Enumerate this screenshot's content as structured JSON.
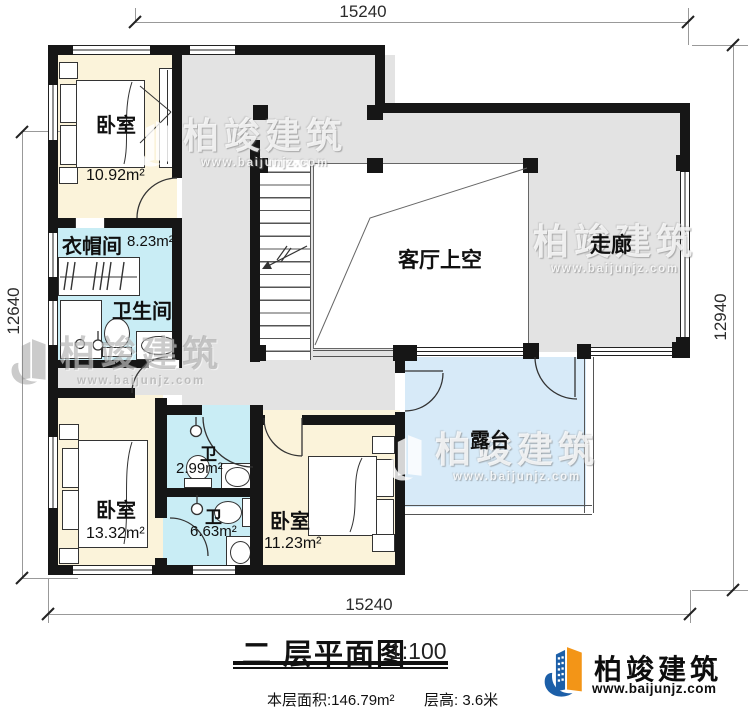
{
  "dims": {
    "top": "15240",
    "bottom": "15240",
    "left": "12640",
    "right": "12940"
  },
  "rooms": {
    "bedroom_tl": {
      "label": "卧室",
      "area": "10.92m²"
    },
    "cloakroom": {
      "label": "衣帽间",
      "area": "8.23m²"
    },
    "bathroom": {
      "label": "卫生间"
    },
    "living_void": {
      "label": "客厅上空"
    },
    "corridor": {
      "label": "走廊"
    },
    "bath_small": {
      "label": "卫",
      "area": "2.99m²"
    },
    "bath_mid": {
      "label": "卫",
      "area": "6.63m²"
    },
    "bedroom_bl": {
      "label": "卧室",
      "area": "13.32m²"
    },
    "bedroom_br": {
      "label": "卧室",
      "area": "11.23m²"
    },
    "terrace": {
      "label": "露台"
    }
  },
  "footer": {
    "title": "二 层平面图",
    "scale": "1:100",
    "area_label": "本层面积:146.79m²",
    "height_label": "层高: 3.6米"
  },
  "brand": {
    "name": "柏竣建筑",
    "url": "www.baijunjz.com"
  },
  "watermark": {
    "name": "柏竣建筑",
    "url": "www.baijunjz.com"
  },
  "colors": {
    "wall": "#161616",
    "hall_fill": "#e3e3e3",
    "bedroom_fill": "#fbf3da",
    "bath_fill": "#c9edf5",
    "terrace_fill": "#d7eaf8",
    "line": "#333333",
    "dim_line": "#999999",
    "logo_blue": "#1c5fa8",
    "logo_orange": "#f39517"
  }
}
